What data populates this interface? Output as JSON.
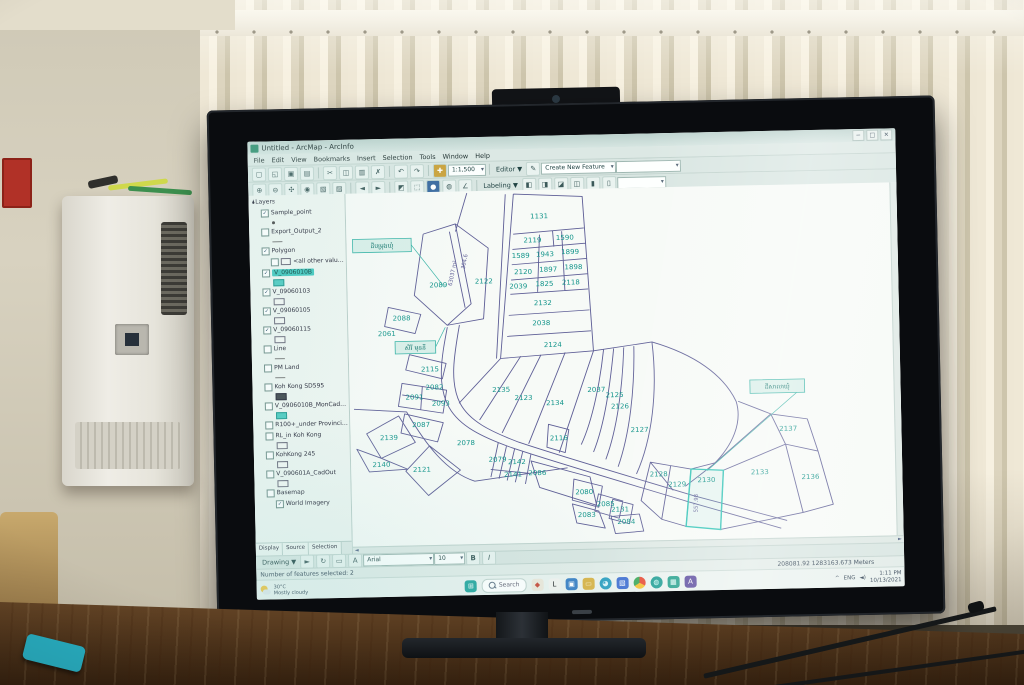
{
  "screen": {
    "titlebar": {
      "title": "Untitled - ArcMap - ArcInfo",
      "window_controls": [
        "─",
        "□",
        "✕"
      ]
    },
    "menus": [
      "File",
      "Edit",
      "View",
      "Bookmarks",
      "Insert",
      "Selection",
      "Tools",
      "Window",
      "Help"
    ],
    "toolbar": {
      "scale_value": "1:1,500",
      "editor_label": "Editor ▼",
      "task_combo": "Create New Feature",
      "labeling_label": "Labeling ▼",
      "row1": [
        {
          "n": "new-map-icon",
          "g": "▢"
        },
        {
          "n": "open-icon",
          "g": "◱"
        },
        {
          "n": "save-icon",
          "g": "▣"
        },
        {
          "n": "print-icon",
          "g": "▤"
        },
        {
          "n": "sep"
        },
        {
          "n": "cut-icon",
          "g": "✂"
        },
        {
          "n": "copy-icon",
          "g": "◫"
        },
        {
          "n": "paste-icon",
          "g": "▥"
        },
        {
          "n": "delete-icon",
          "g": "✗"
        },
        {
          "n": "sep"
        },
        {
          "n": "undo-icon",
          "g": "↶"
        },
        {
          "n": "redo-icon",
          "g": "↷"
        },
        {
          "n": "sep"
        },
        {
          "n": "add-data-icon",
          "g": "✚",
          "c": "#caa23c"
        }
      ],
      "row2": [
        {
          "n": "zoom-in-icon",
          "g": "⊕"
        },
        {
          "n": "zoom-out-icon",
          "g": "⊖"
        },
        {
          "n": "pan-icon",
          "g": "✣"
        },
        {
          "n": "full-extent-icon",
          "g": "◉"
        },
        {
          "n": "fixed-zoom-in-icon",
          "g": "▧"
        },
        {
          "n": "fixed-zoom-out-icon",
          "g": "▨"
        },
        {
          "n": "sep"
        },
        {
          "n": "back-extent-icon",
          "g": "◄"
        },
        {
          "n": "forward-extent-icon",
          "g": "►"
        },
        {
          "n": "sep"
        },
        {
          "n": "select-features-icon",
          "g": "◩"
        },
        {
          "n": "clear-selection-icon",
          "g": "⬚"
        },
        {
          "n": "identify-icon",
          "g": "●",
          "c": "#3a6aa0"
        },
        {
          "n": "find-icon",
          "g": "◍"
        },
        {
          "n": "measure-icon",
          "g": "∠"
        }
      ],
      "labeling_icons": [
        {
          "n": "label-manager-icon",
          "g": "◧"
        },
        {
          "n": "label-priority-icon",
          "g": "◨"
        },
        {
          "n": "label-weight-icon",
          "g": "◪"
        },
        {
          "n": "lock-labels-icon",
          "g": "◫"
        },
        {
          "n": "pause-labeling-icon",
          "g": "▮"
        },
        {
          "n": "view-unplaced-icon",
          "g": "▯"
        }
      ],
      "label_scale_combo": " "
    },
    "toc": {
      "items": [
        {
          "label": "Layers",
          "depth": 0,
          "root": true
        },
        {
          "label": "Sample_point",
          "depth": 1,
          "chk": true,
          "sym": "dot"
        },
        {
          "label": "Export_Output_2",
          "depth": 1,
          "chk": false,
          "sym": "line"
        },
        {
          "label": "Polygon",
          "depth": 1,
          "chk": true
        },
        {
          "label": "<all other values>",
          "depth": 2,
          "chk": false,
          "symInline": "outline"
        },
        {
          "label": "V_0906010B",
          "depth": 1,
          "chk": true,
          "sel": true,
          "sym": "teal"
        },
        {
          "label": "V_09060103",
          "depth": 1,
          "chk": true,
          "sym": "outline"
        },
        {
          "label": "V_09060105",
          "depth": 1,
          "chk": true,
          "sym": "outline"
        },
        {
          "label": "V_09060115",
          "depth": 1,
          "chk": true,
          "sym": "outline"
        },
        {
          "label": "Line",
          "depth": 1,
          "chk": false,
          "sym": "line"
        },
        {
          "label": "PM Land",
          "depth": 1,
          "chk": false,
          "sym": "line"
        },
        {
          "label": "Koh Kong SD595",
          "depth": 1,
          "chk": false,
          "sym": "dark"
        },
        {
          "label": "V_0906010B_MonCadOut",
          "depth": 1,
          "chk": false,
          "sym": "teal"
        },
        {
          "label": "R100+_under Provincial Managem",
          "depth": 1,
          "chk": false
        },
        {
          "label": "RL_in Koh Kong",
          "depth": 1,
          "chk": false,
          "sym": "outline"
        },
        {
          "label": "KohKong 245",
          "depth": 1,
          "chk": false,
          "sym": "outline"
        },
        {
          "label": "V_090601A_CadOut",
          "depth": 1,
          "chk": false,
          "sym": "outline"
        },
        {
          "label": "Basemap",
          "depth": 1,
          "chk": false
        },
        {
          "label": "World Imagery",
          "depth": 2,
          "chk": true
        }
      ],
      "tabs": [
        "Display",
        "Source",
        "Selection"
      ]
    },
    "map": {
      "boundary_color": "#5e5e96",
      "label_color": "#12948a",
      "selected_color": "#2ec4b6",
      "labels": [
        {
          "t": "1131",
          "x": 191,
          "y": 30
        },
        {
          "t": "2119",
          "x": 184,
          "y": 55
        },
        {
          "t": "1590",
          "x": 216,
          "y": 53
        },
        {
          "t": "1589",
          "x": 172,
          "y": 71
        },
        {
          "t": "1943",
          "x": 196,
          "y": 70
        },
        {
          "t": "1899",
          "x": 221,
          "y": 68
        },
        {
          "t": "2120",
          "x": 174,
          "y": 88
        },
        {
          "t": "1897",
          "x": 199,
          "y": 86
        },
        {
          "t": "1898",
          "x": 224,
          "y": 84
        },
        {
          "t": "2039",
          "x": 169,
          "y": 103
        },
        {
          "t": "1825",
          "x": 195,
          "y": 101
        },
        {
          "t": "2118",
          "x": 221,
          "y": 100
        },
        {
          "t": "2132",
          "x": 193,
          "y": 121
        },
        {
          "t": "2038",
          "x": 191,
          "y": 142
        },
        {
          "t": "2124",
          "x": 202,
          "y": 165
        },
        {
          "t": "2089",
          "x": 90,
          "y": 100
        },
        {
          "t": "2122",
          "x": 135,
          "y": 97
        },
        {
          "t": "2088",
          "x": 53,
          "y": 134
        },
        {
          "t": "2061",
          "x": 38,
          "y": 150
        },
        {
          "t": "2115",
          "x": 80,
          "y": 188
        },
        {
          "t": "2082",
          "x": 84,
          "y": 207
        },
        {
          "t": "2091",
          "x": 64,
          "y": 217
        },
        {
          "t": "2093",
          "x": 90,
          "y": 224
        },
        {
          "t": "2087",
          "x": 70,
          "y": 246
        },
        {
          "t": "2135",
          "x": 150,
          "y": 211
        },
        {
          "t": "2123",
          "x": 172,
          "y": 220
        },
        {
          "t": "2134",
          "x": 203,
          "y": 226
        },
        {
          "t": "2037",
          "x": 244,
          "y": 213
        },
        {
          "t": "2125",
          "x": 262,
          "y": 219
        },
        {
          "t": "2126",
          "x": 267,
          "y": 231
        },
        {
          "t": "2127",
          "x": 286,
          "y": 256
        },
        {
          "t": "2116",
          "x": 206,
          "y": 263
        },
        {
          "t": "2078",
          "x": 114,
          "y": 266
        },
        {
          "t": "2079",
          "x": 145,
          "y": 284
        },
        {
          "t": "2142",
          "x": 164,
          "y": 287
        },
        {
          "t": "2141",
          "x": 160,
          "y": 300
        },
        {
          "t": "2086",
          "x": 184,
          "y": 299
        },
        {
          "t": "2080",
          "x": 230,
          "y": 320
        },
        {
          "t": "2085",
          "x": 251,
          "y": 333
        },
        {
          "t": "2083",
          "x": 232,
          "y": 344
        },
        {
          "t": "2131",
          "x": 265,
          "y": 339
        },
        {
          "t": "2084",
          "x": 271,
          "y": 352
        },
        {
          "t": "2128",
          "x": 304,
          "y": 303
        },
        {
          "t": "2129",
          "x": 322,
          "y": 314
        },
        {
          "t": "2130",
          "x": 351,
          "y": 310
        },
        {
          "t": "2133",
          "x": 404,
          "y": 303
        },
        {
          "t": "2136",
          "x": 454,
          "y": 309
        },
        {
          "t": "2137",
          "x": 433,
          "y": 258
        },
        {
          "t": "2139",
          "x": 38,
          "y": 259
        },
        {
          "t": "2140",
          "x": 30,
          "y": 287
        },
        {
          "t": "2121",
          "x": 70,
          "y": 293
        }
      ],
      "rotated_labels": [
        {
          "t": "63037 m²",
          "x": 106,
          "y": 86,
          "r": -78
        },
        {
          "t": "304.6",
          "x": 118,
          "y": 74,
          "r": -78
        },
        {
          "t": "557.98",
          "x": 342,
          "y": 332,
          "r": -88
        }
      ],
      "callouts": [
        {
          "t": "ដីបម្រុងឃុំ",
          "x": 6,
          "y": 48,
          "w": 58,
          "h": 14,
          "lx": 96,
          "ly": 100
        },
        {
          "t": "សិរី មុននី",
          "x": 46,
          "y": 156,
          "w": 40,
          "h": 13,
          "lx": 96,
          "ly": 142
        },
        {
          "t": "ដីសាលាឃុំ",
          "x": 396,
          "y": 204,
          "w": 54,
          "h": 14,
          "lx": 352,
          "ly": 298
        }
      ]
    },
    "drawbar": {
      "drawing_label": "Drawing ▼",
      "icons": [
        {
          "n": "select-elements-icon",
          "g": "►"
        },
        {
          "n": "rotate-element-icon",
          "g": "↻"
        },
        {
          "n": "shape-tool-icon",
          "g": "▭"
        },
        {
          "n": "text-tool-icon",
          "g": "A"
        }
      ],
      "font_combo": "Arial",
      "size_combo": "10",
      "bold_label": "B",
      "italic_label": "I"
    },
    "statusbar": {
      "left": "Number of features selected: 2",
      "right": "208081.92  1283163.673 Meters"
    },
    "taskbar": {
      "search_placeholder": "Search",
      "weather_temp": "30°C",
      "weather_text": "Mostly cloudy",
      "start_color": "#2aa7a0",
      "apps": [
        {
          "n": "colorful-app-icon",
          "c": "#ece7db",
          "g": "◆",
          "gc": "#c94f3f"
        },
        {
          "n": "l-app-icon",
          "c": "#f2f2ef",
          "g": "L",
          "gc": "#16181a"
        },
        {
          "n": "microsoft-store-icon",
          "c": "#3f83c6",
          "g": "▣",
          "gc": "#ffffff"
        },
        {
          "n": "file-explorer-icon",
          "c": "#d9b44a",
          "g": "▭",
          "gc": "#f8ecc6"
        },
        {
          "n": "edge-browser-icon",
          "c": "#2d9fc0",
          "g": "◕",
          "gc": "#d8f2f8",
          "round": true
        },
        {
          "n": "photos-app-icon",
          "c": "#3f6fd1",
          "g": "▧",
          "gc": "#ffffff"
        },
        {
          "n": "chrome-icon",
          "c": "conic",
          "g": "",
          "gc": "",
          "round": true
        },
        {
          "n": "arcgis-globe-icon",
          "c": "#1f9e94",
          "g": "◍",
          "gc": "#d9fff9",
          "round": true
        },
        {
          "n": "green-app-icon",
          "c": "#23a08c",
          "g": "▦",
          "gc": "#e8fffb"
        },
        {
          "n": "acrobat-icon",
          "c": "#5a4a9e",
          "g": "A",
          "gc": "#ffffff"
        }
      ],
      "tray": {
        "chevron": "^",
        "lang": "ENG",
        "speaker": "◄)",
        "time": "1:11 PM",
        "date": "10/13/2021"
      }
    }
  }
}
